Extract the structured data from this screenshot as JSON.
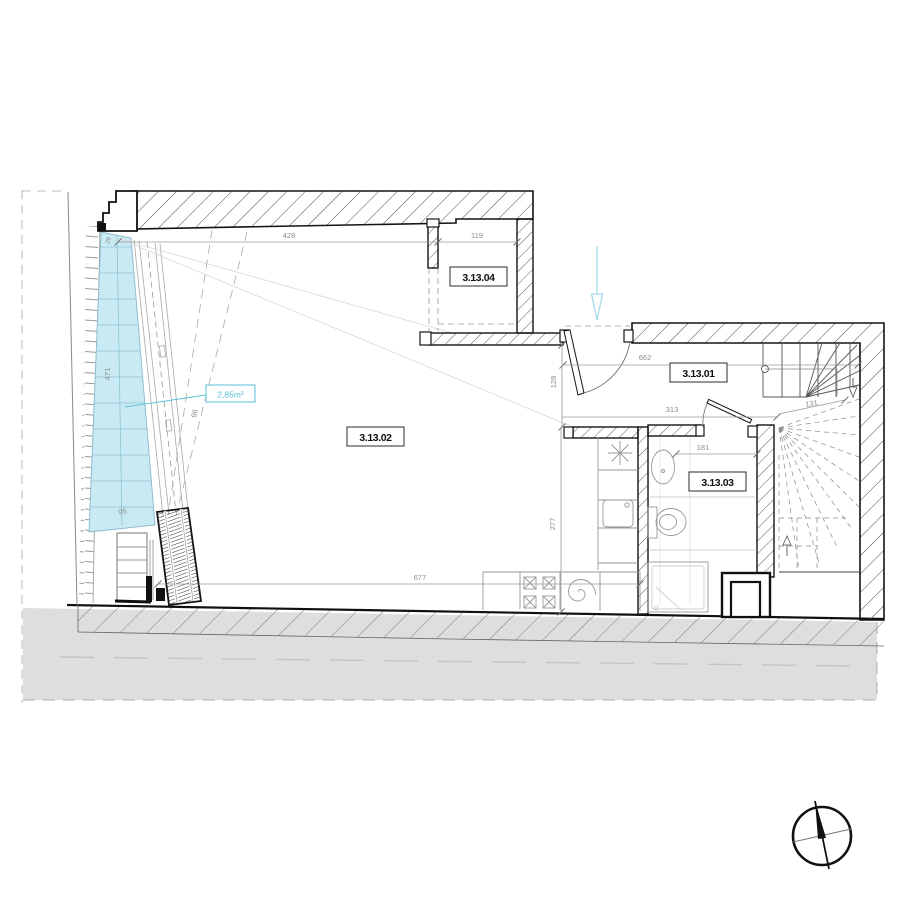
{
  "room_labels": {
    "r01": "3.13.01",
    "r02": "3.13.02",
    "r03": "3.13.03",
    "r04": "3.13.04"
  },
  "area_label": "2,85m²",
  "dims": {
    "top_left": "428",
    "closet": "119",
    "hall": "662",
    "entry_return": "128",
    "bath_top": "313",
    "stair": "131",
    "bath_width": "181",
    "kitchen_depth": "277",
    "room_width": "677",
    "glazing_len": "471",
    "glazing_bottom": "95",
    "glazing_diag": "96",
    "glazing_top": "29"
  },
  "icons": {
    "north_compass": "north-compass-icon",
    "entrance_arrow": "entrance-direction-arrow-icon"
  },
  "colors": {
    "glazing_fill": "#c9e9f3",
    "glazing_edge": "#86b9cc",
    "accent_cyan": "#58c2d8",
    "arrow_cyan": "#a6dcea",
    "terrain_gray": "#dedede",
    "wall_black": "#141414",
    "dim_gray": "#8c8c8c"
  }
}
